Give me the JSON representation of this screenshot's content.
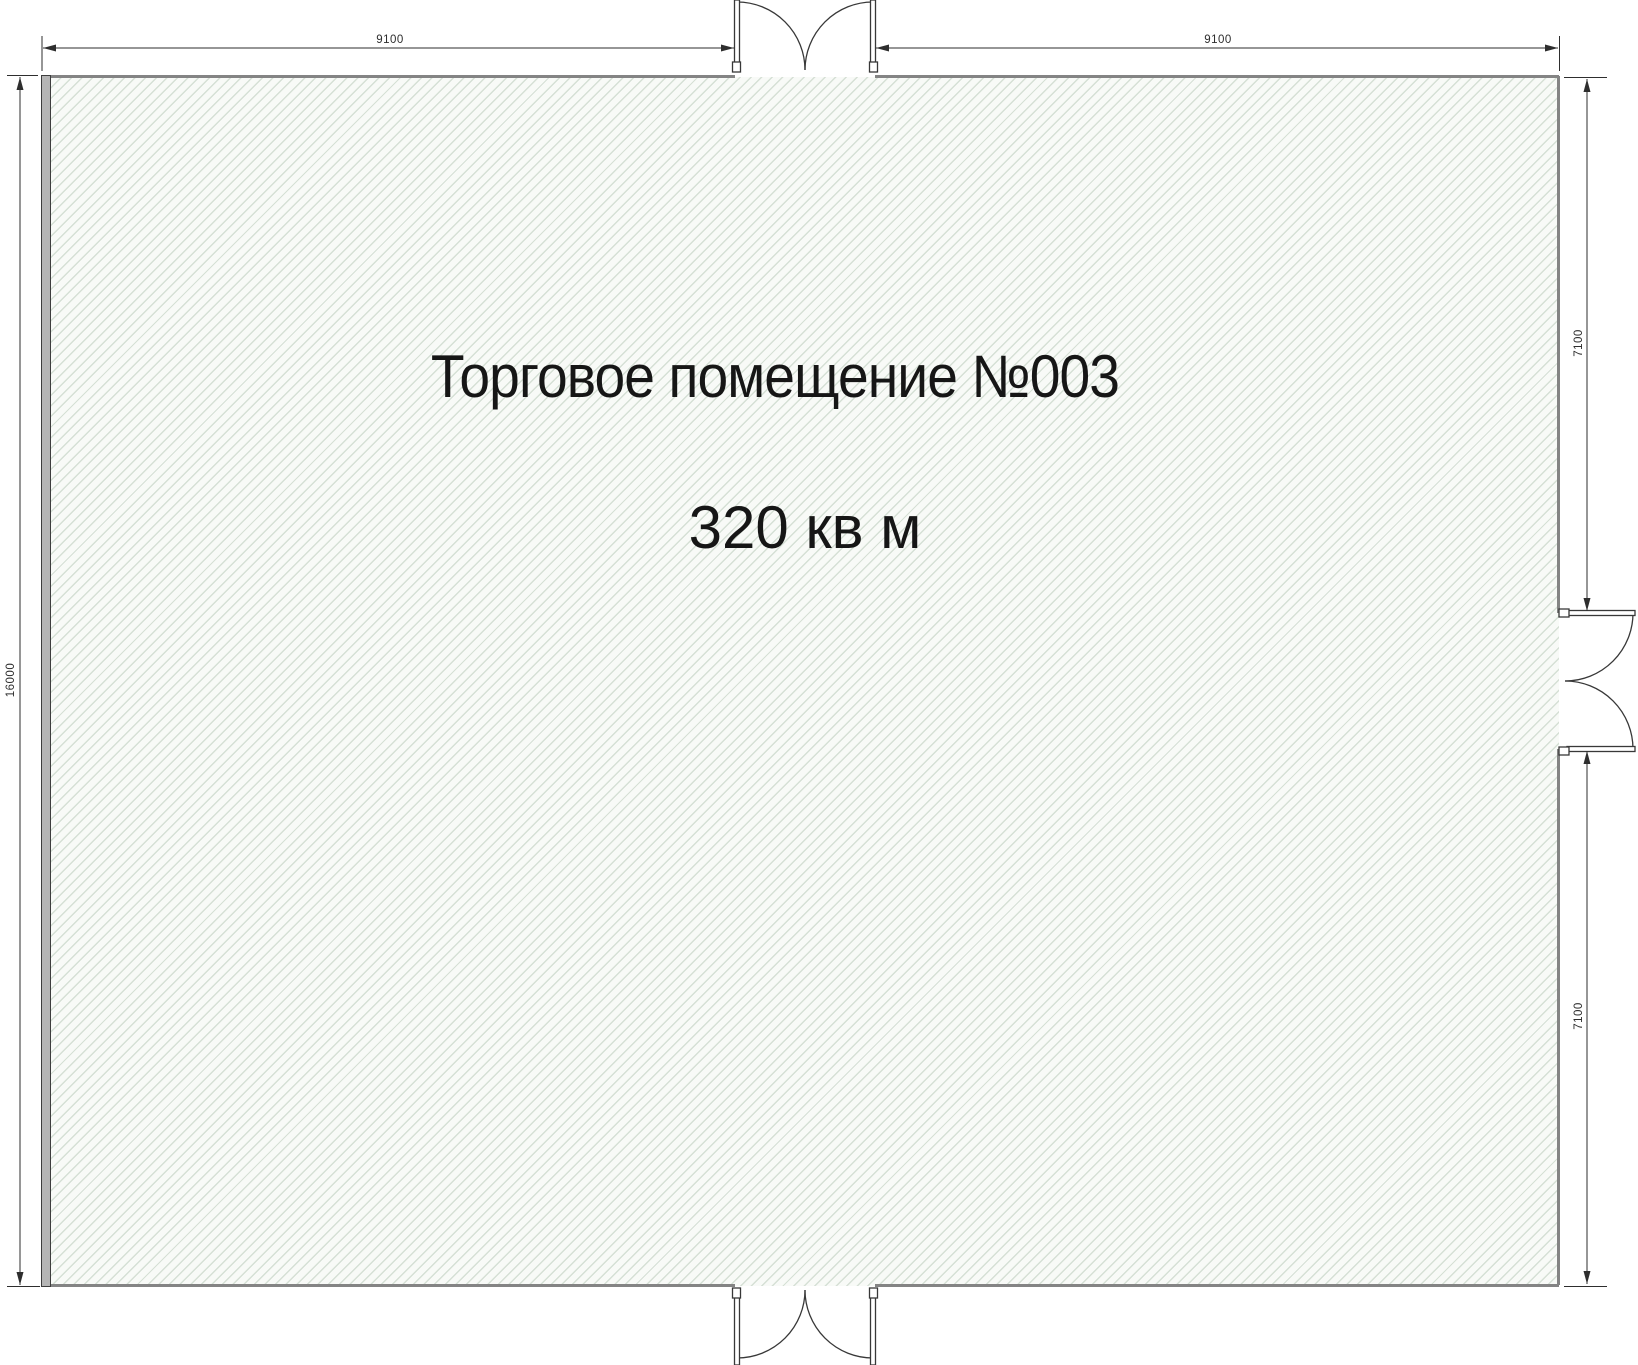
{
  "plan": {
    "title": "Торговое помещение №003",
    "area": "320 кв м",
    "dimensions": {
      "top_left": "9100",
      "top_right": "9100",
      "left": "16000",
      "right_upper": "7100",
      "right_lower": "7100"
    },
    "colors": {
      "floor_fill": "#f8faf7",
      "hatch_stripe": "#dde6dd",
      "wall_gray": "#848484",
      "left_wall_fill": "#b5b5b5",
      "line_dark": "#2e2e2e",
      "text": "#161616"
    },
    "elements": {
      "doors": [
        {
          "name": "top-double-door"
        },
        {
          "name": "bottom-double-door"
        },
        {
          "name": "right-double-door"
        }
      ]
    }
  }
}
